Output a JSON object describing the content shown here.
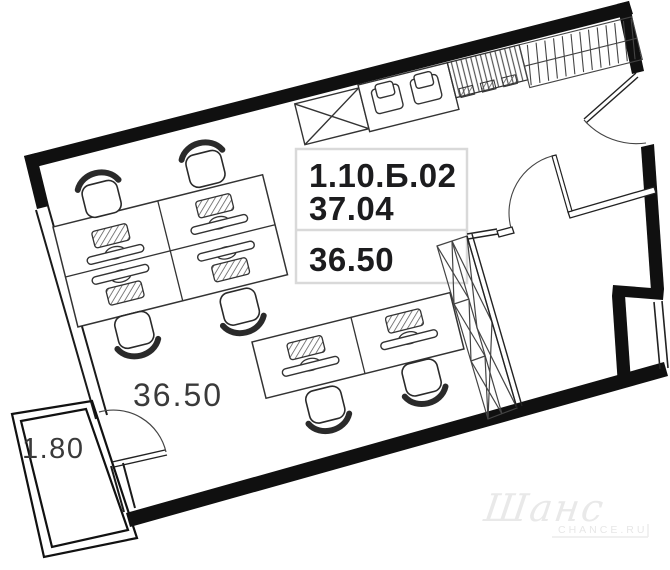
{
  "floor_plan": {
    "unit_code": "1.10.Б.02",
    "total_area": "37.04",
    "living_area": "36.50",
    "room_area_label": "36.50",
    "balcony_area_label": "1.80"
  },
  "watermark": {
    "brand_script": "Шанс",
    "brand_caption": "CHANCE.RU"
  },
  "colors": {
    "wall": "#101010",
    "furniture_line": "#333333",
    "label_box_border": "#d9d9d9",
    "bold_text": "#1c1c1e",
    "area_text": "#3a3a3a",
    "watermark": "#e9e9e9"
  },
  "icons": {
    "office-chair-icon": "rounded seat with arc back",
    "workstation-icon": "hatched keyboard + monitor bar",
    "kitchen-appliance-icon": "rounded square with lid",
    "crossed-box-icon": "rectangle with X diagonals",
    "wardrobe-icon": "strip of X-crossed cells",
    "hatch-unit-icon": "densely hatched cabinet",
    "tick-rail-icon": "rail with diagonal ticks",
    "door-arc-icon": "quarter-circle door swing",
    "window-icon": "double parallel lines"
  }
}
